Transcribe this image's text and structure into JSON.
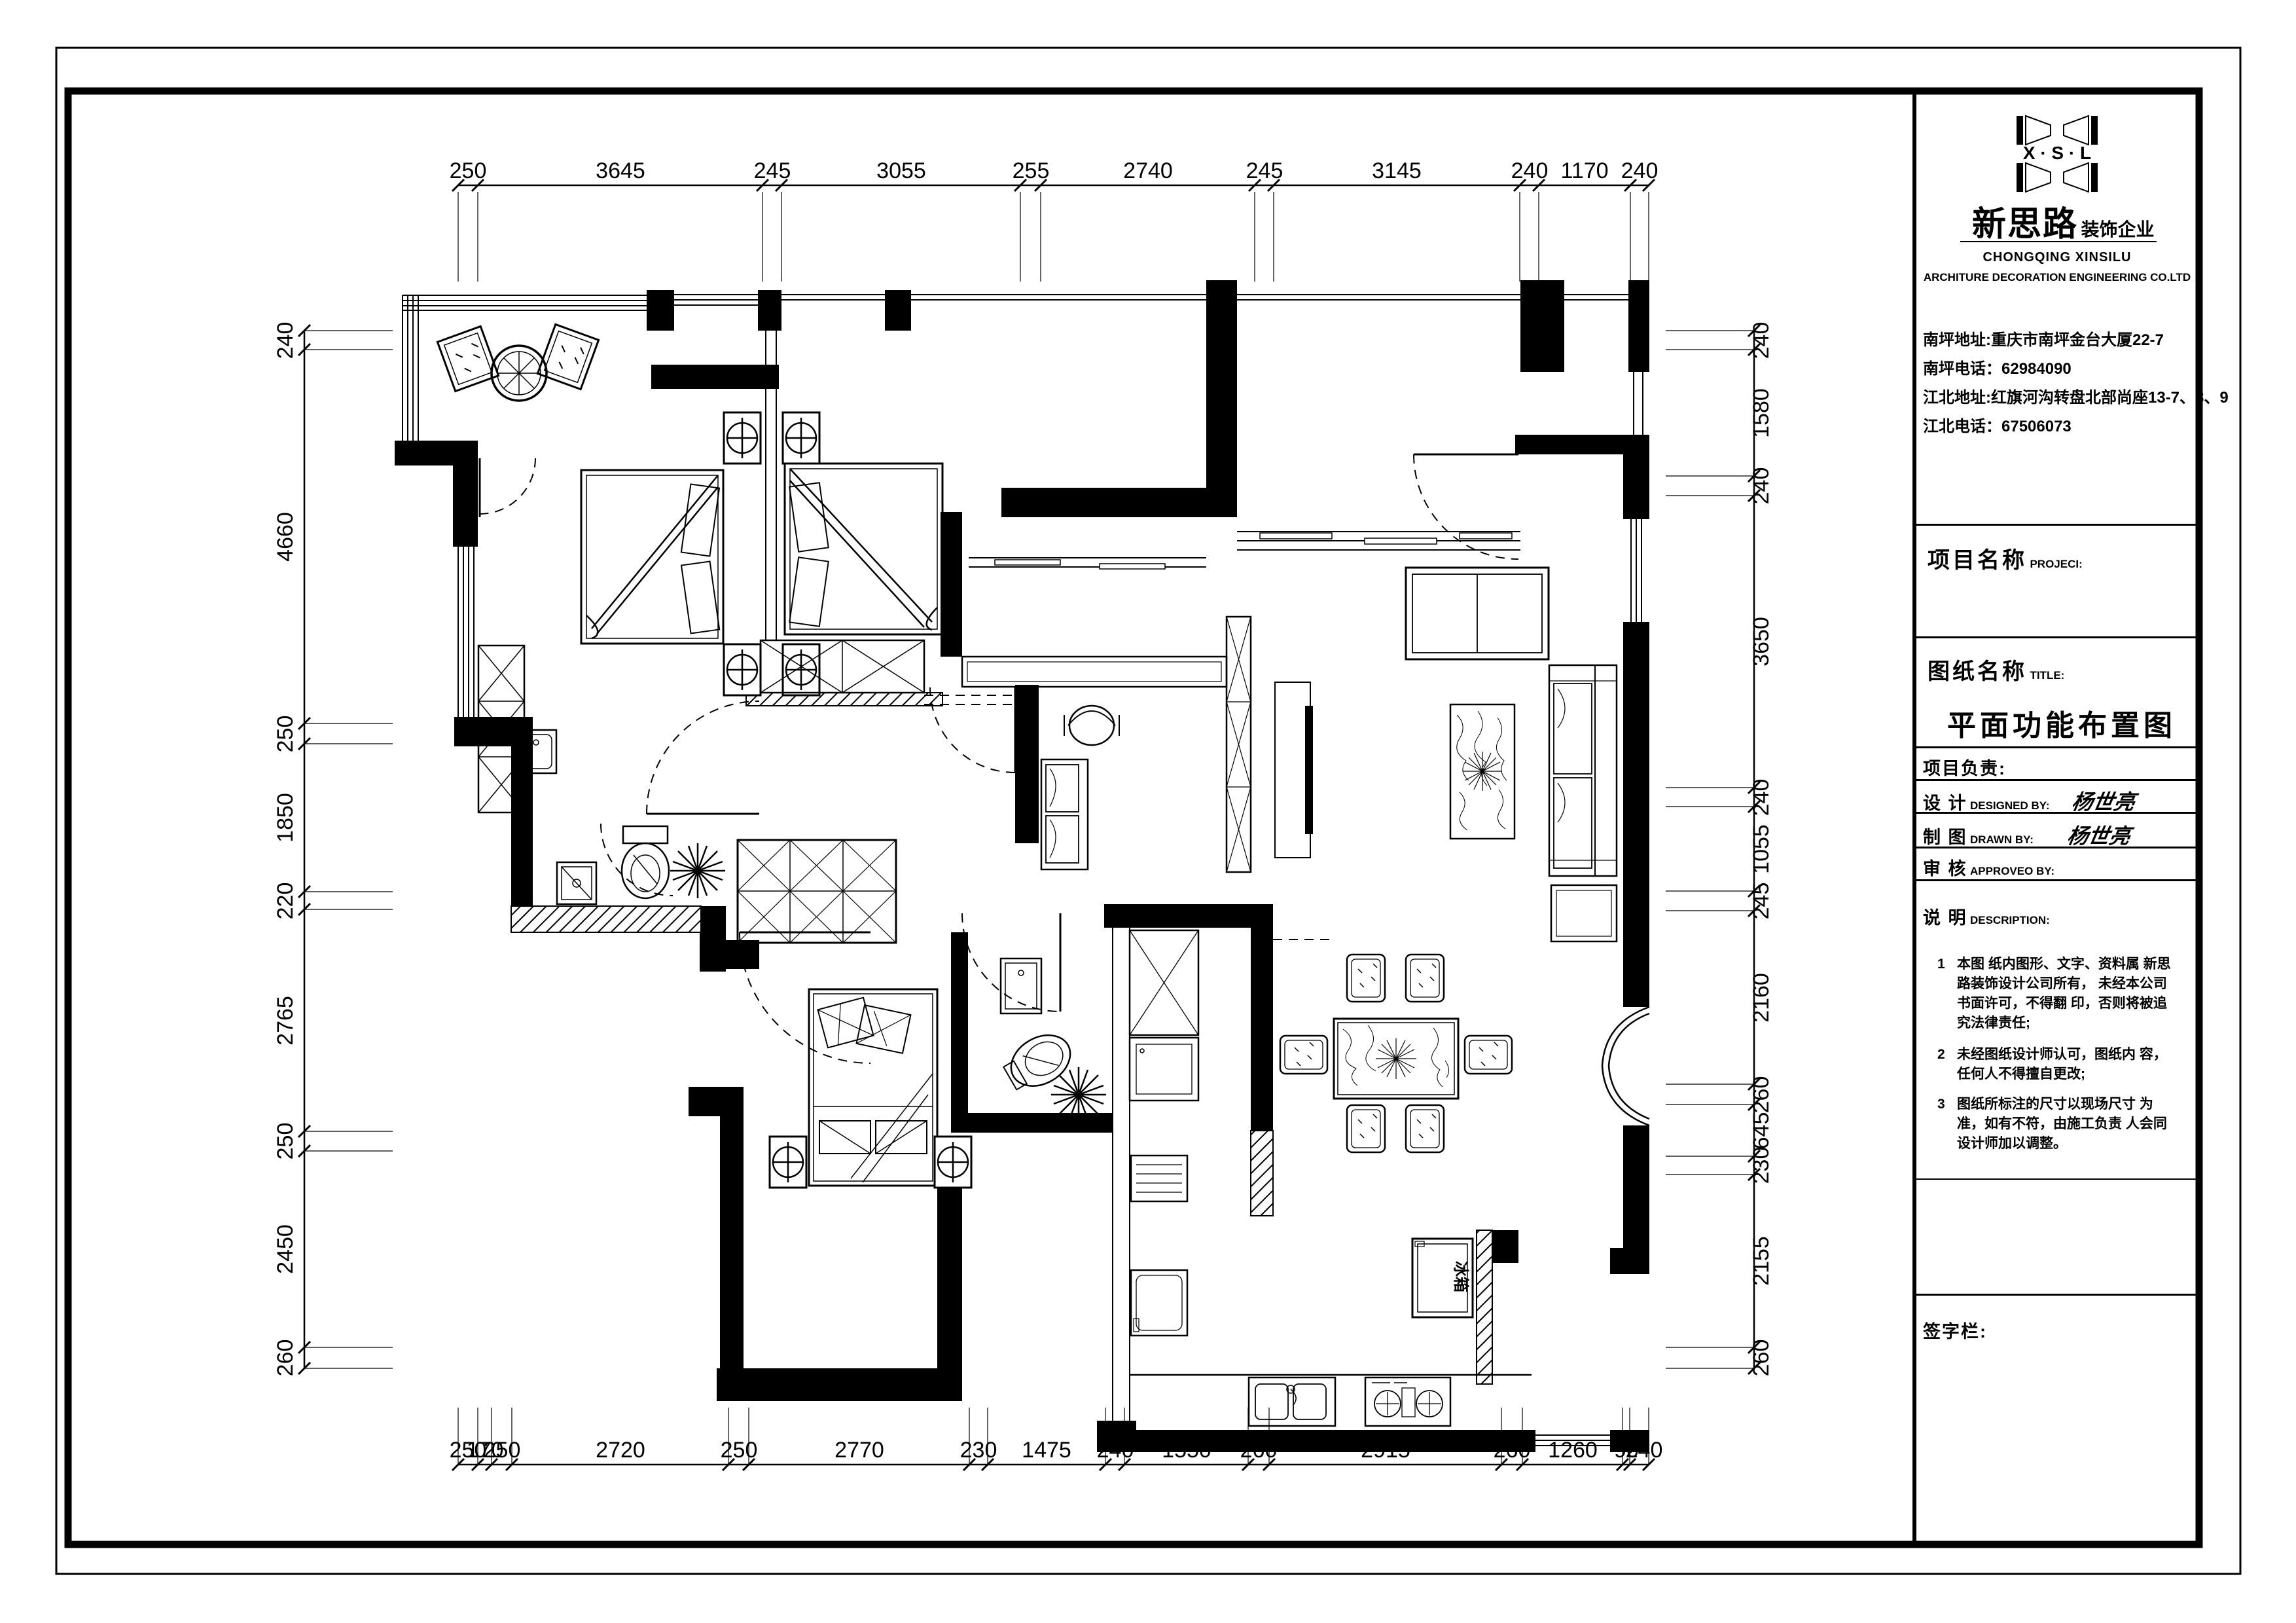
{
  "page": {
    "bg": "#ffffff",
    "ink": "#000000"
  },
  "title_block": {
    "logo": {
      "initials": "X · S · L",
      "name_cn": "新思路",
      "suffix_cn": "装饰企业",
      "name_en": "CHONGQING XINSILU",
      "name_en2": "ARCHITURE DECORATION ENGINEERING CO.LTD"
    },
    "contacts": [
      "南坪地址:重庆市南坪金台大厦22-7",
      "南坪电话：62984090",
      "江北地址:红旗河沟转盘北部尚座13-7、8、9",
      "江北电话：67506073"
    ],
    "project": {
      "label": "项目名称",
      "label_en": "PROJECI:"
    },
    "sheet": {
      "label": "图纸名称",
      "label_en": "TITLE:",
      "value": "平面功能布置图"
    },
    "manager": {
      "label": "项目负责:"
    },
    "designed": {
      "label": "设  计",
      "label_en": "DESIGNED BY:",
      "value": "杨世亮"
    },
    "drawn": {
      "label": "制  图",
      "label_en": "DRAWN BY:",
      "value": "杨世亮"
    },
    "approved": {
      "label": "审  核",
      "label_en": "APPROVEO BY:"
    },
    "description": {
      "label": "说  明",
      "label_en": "DESCRIPTION:",
      "notes": [
        {
          "no": "1",
          "text": "本图 纸内图形、文字、资料属 新思路装饰设计公司所有， 未经本公司书面许可，不得翻 印，否则将被追究法律责任;"
        },
        {
          "no": "2",
          "text": "未经图纸设计师认可，图纸内 容，任何人不得擅自更改;"
        },
        {
          "no": "3",
          "text": "图纸所标注的尺寸以现场尺寸 为准，如有不符，由施工负责 人会同设计师加以调整。"
        }
      ]
    },
    "signature": {
      "label": "签字栏:"
    }
  },
  "plan": {
    "fridge_label": "冰箱"
  },
  "dims": {
    "top": [
      "250",
      "3645",
      "245",
      "3055",
      "255",
      "2740",
      "245",
      "3145",
      "240",
      "1170",
      "240"
    ],
    "bottom": [
      "250",
      "170",
      "250",
      "2720",
      "250",
      "2770",
      "230",
      "1475",
      "240",
      "1550",
      "260",
      "2915",
      "260",
      "1260",
      "90",
      "240"
    ],
    "left": [
      "240",
      "4660",
      "250",
      "1850",
      "220",
      "2765",
      "250",
      "2450",
      "260"
    ],
    "right": [
      "240",
      "1580",
      "240",
      "3650",
      "240",
      "1055",
      "245",
      "2160",
      "260",
      "645",
      "230",
      "2155",
      "260"
    ]
  }
}
